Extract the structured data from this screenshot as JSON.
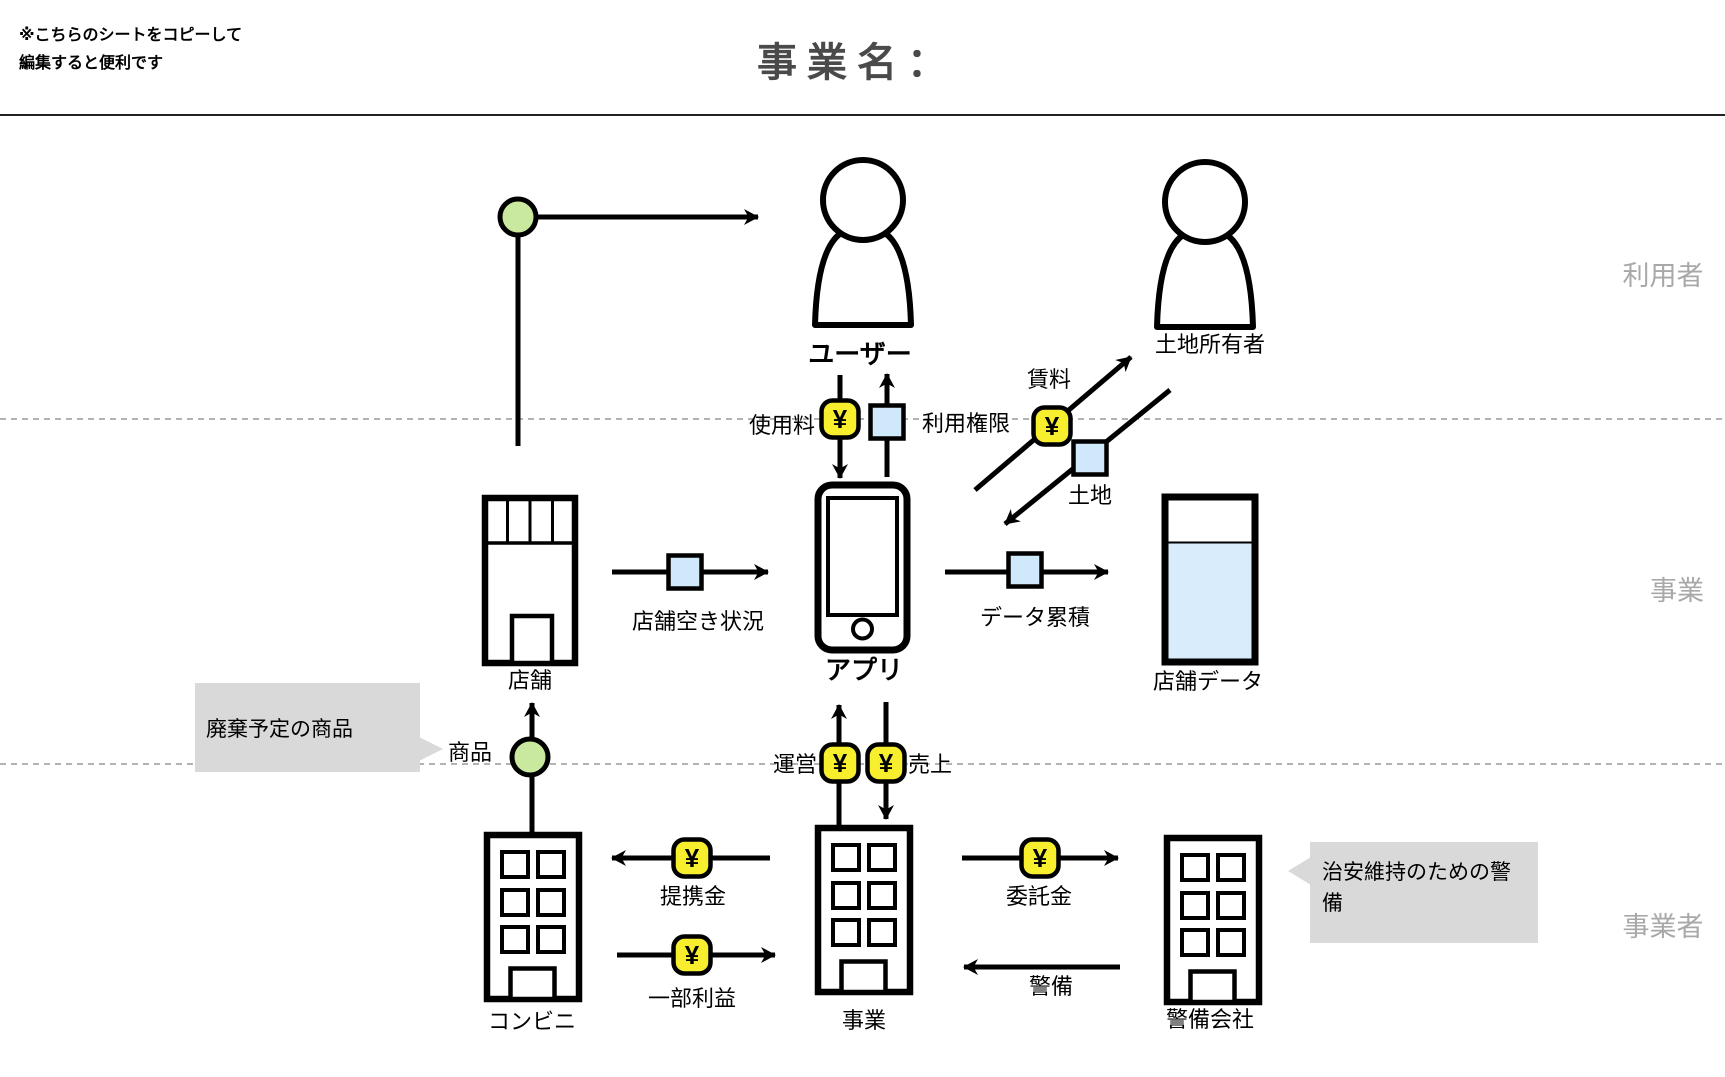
{
  "header": {
    "note": [
      "※こちらのシートをコピーして",
      "編集すると便利です"
    ],
    "title": "事業名："
  },
  "sections": {
    "users_label": "利用者",
    "business_label": "事業",
    "operator_label": "事業者"
  },
  "symbols": {
    "yen": "¥"
  },
  "nodes": {
    "user": "ユーザー",
    "landowner": "土地所有者",
    "store": "店舗",
    "app": "アプリ",
    "store_data": "店舗データ",
    "convenience_store": "コンビニ",
    "business": "事業",
    "security_company": "警備会社"
  },
  "flows": {
    "usage_fee": "使用料",
    "usage_rights": "利用権限",
    "rent": "賃料",
    "land": "土地",
    "store_vacancy": "店舗空き状況",
    "data_accumulation": "データ累積",
    "goods": "商品",
    "operation": "運営",
    "sales": "売上",
    "partnership_fee": "提携金",
    "partial_profit": "一部利益",
    "commission_fee": "委託金",
    "security": "警備"
  },
  "callouts": {
    "disposal_products": "廃棄予定の商品",
    "security_reason": "治安維持のための警備"
  },
  "icons": {
    "person": "person-icon",
    "smartphone": "smartphone-icon",
    "store": "storefront-icon",
    "database": "data-tank-icon",
    "building": "office-building-icon",
    "money": "yen-badge-icon",
    "item": "item-square-icon",
    "goods": "goods-circle-icon"
  },
  "colors": {
    "badge_yellow": "#f7ee2e",
    "item_blue": "#cfe9fa",
    "data_fill_blue": "#d8ecfb",
    "goods_green": "#c9ea9e",
    "callout_gray": "#d9d9d9",
    "section_label_gray": "#a8a8a8",
    "title_gray": "#4a4a4a"
  }
}
